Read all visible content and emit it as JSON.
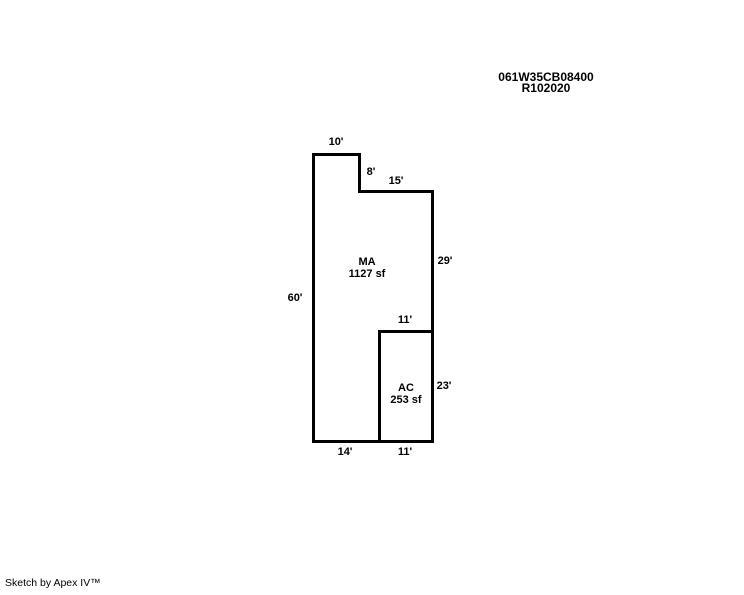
{
  "header": {
    "parcel_number": "061W35CB08400",
    "record_number": "R102020"
  },
  "sketch": {
    "colors": {
      "line": "#000000",
      "background": "#ffffff",
      "text": "#000000"
    },
    "areas": {
      "ma": {
        "code": "MA",
        "size": "1127 sf"
      },
      "ac": {
        "code": "AC",
        "size": "253 sf"
      }
    },
    "dims": {
      "top_width": "10'",
      "notch_height": "8'",
      "upper_right_width": "15'",
      "right_upper_height": "29'",
      "left_height": "60'",
      "ac_top_width": "11'",
      "ac_right_height": "23'",
      "bottom_left_width": "14'",
      "bottom_right_width": "11'"
    }
  },
  "footer": {
    "credit": "Sketch by Apex IV™"
  }
}
